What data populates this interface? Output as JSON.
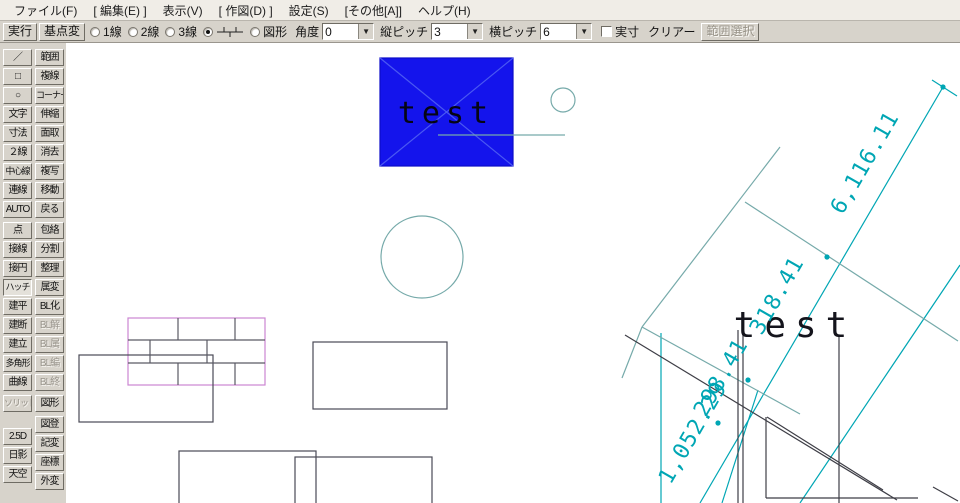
{
  "menu": {
    "items": [
      "ファイル(F)",
      "[ 編集(E) ]",
      "表示(V)",
      "[ 作図(D) ]",
      "設定(S)",
      "[その他[A]]",
      "ヘルプ(H)"
    ]
  },
  "toolbar": {
    "buttons": [
      {
        "label": "実行",
        "name": "execute-button"
      },
      {
        "label": "基点変",
        "name": "base-point-change-button"
      }
    ],
    "radios": [
      {
        "label": "1線",
        "selected": false
      },
      {
        "label": "2線",
        "selected": false
      },
      {
        "label": "3線",
        "selected": false
      },
      {
        "icon": "brick-pitch-icon",
        "selected": true
      },
      {
        "label": "図形",
        "selected": false
      }
    ],
    "fields": [
      {
        "label": "角度",
        "value": "0"
      },
      {
        "label": "縦ピッチ",
        "value": "3"
      },
      {
        "label": "横ピッチ",
        "value": "6"
      }
    ],
    "checkbox": {
      "label": "実寸",
      "checked": false
    },
    "clear_label": "クリアー",
    "range_select": {
      "label": "範囲選択",
      "disabled": true
    }
  },
  "sidebar": {
    "groups": [
      {
        "col1": [
          {
            "label": "／",
            "name": "line-tool-icon"
          },
          {
            "label": "□",
            "name": "rect-tool-icon"
          },
          {
            "label": "○",
            "name": "circle-tool-icon"
          },
          {
            "label": "文字"
          },
          {
            "label": "寸法"
          },
          {
            "label": "２線"
          },
          {
            "label": "中心線",
            "long": true
          },
          {
            "label": "連線"
          },
          {
            "label": "AUTO"
          }
        ],
        "col2": [
          {
            "label": "範囲"
          },
          {
            "label": "複線"
          },
          {
            "label": "コーナー",
            "long": true
          },
          {
            "label": "伸縮"
          },
          {
            "label": "面取"
          },
          {
            "label": "消去"
          },
          {
            "label": "複写"
          },
          {
            "label": "移動"
          },
          {
            "label": "戻る"
          }
        ]
      },
      {
        "col1": [
          {
            "label": "点"
          },
          {
            "label": "接線"
          },
          {
            "label": "接円"
          },
          {
            "label": "ハッチ",
            "active": true,
            "long": true
          },
          {
            "label": "建平"
          },
          {
            "label": "建断"
          },
          {
            "label": "建立"
          },
          {
            "label": "多角形",
            "long": true
          },
          {
            "label": "曲線"
          }
        ],
        "col2": [
          {
            "label": "包絡"
          },
          {
            "label": "分割"
          },
          {
            "label": "整理"
          },
          {
            "label": "属変"
          },
          {
            "label": "BL化"
          },
          {
            "label": "BL解",
            "disabled": true
          },
          {
            "label": "BL属",
            "disabled": true
          },
          {
            "label": "BL編",
            "disabled": true
          },
          {
            "label": "BL終",
            "disabled": true
          }
        ]
      },
      {
        "col1": [
          {
            "label": "ソリッド",
            "disabled": true,
            "long": true
          }
        ],
        "col2": [
          {
            "label": "図形"
          }
        ]
      },
      {
        "col1": [
          {
            "label": "2.5D"
          },
          {
            "label": "日影"
          },
          {
            "label": "天空"
          }
        ],
        "col2": [
          {
            "label": "図登"
          },
          {
            "label": "記変"
          },
          {
            "label": "座標"
          },
          {
            "label": "外変"
          }
        ]
      }
    ]
  },
  "drawing": {
    "colors": {
      "dim": "#00a6b4",
      "aux": "#76aaaa",
      "dark": "#3e3e46",
      "cross": "#4a58f2",
      "hatch": "#5a5a64",
      "hatchBorder": "#cc86d2",
      "outline": "#4a4a56",
      "blueFill": "#1414ec",
      "blueEdge": "#0c0cc8",
      "blueText": "#050514",
      "black": "#14141c"
    },
    "rects": [
      {
        "x": 380,
        "y": 58,
        "w": 133,
        "h": 108,
        "stroke": "blueEdge",
        "fill": "blueFill"
      },
      {
        "x": 128,
        "y": 318,
        "w": 137,
        "h": 67,
        "stroke": "hatchBorder"
      },
      {
        "x": 79,
        "y": 355,
        "w": 134,
        "h": 67,
        "stroke": "outline"
      },
      {
        "x": 313,
        "y": 342,
        "w": 134,
        "h": 67,
        "stroke": "outline"
      },
      {
        "x": 179,
        "y": 451,
        "w": 137,
        "h": 70,
        "stroke": "outline"
      },
      {
        "x": 295,
        "y": 457,
        "w": 137,
        "h": 70,
        "stroke": "outline"
      }
    ],
    "lines": [
      {
        "x1": 380,
        "y1": 58,
        "x2": 513,
        "y2": 166,
        "c": "cross"
      },
      {
        "x1": 380,
        "y1": 166,
        "x2": 513,
        "y2": 58,
        "c": "cross"
      },
      {
        "x1": 438,
        "y1": 135,
        "x2": 565,
        "y2": 135,
        "c": "aux"
      },
      {
        "x1": 128,
        "y1": 340,
        "x2": 265,
        "y2": 340,
        "c": "hatch"
      },
      {
        "x1": 128,
        "y1": 363,
        "x2": 265,
        "y2": 363,
        "c": "hatch"
      },
      {
        "x1": 178,
        "y1": 318,
        "x2": 178,
        "y2": 340,
        "c": "hatch"
      },
      {
        "x1": 235,
        "y1": 318,
        "x2": 235,
        "y2": 340,
        "c": "hatch"
      },
      {
        "x1": 150,
        "y1": 340,
        "x2": 150,
        "y2": 363,
        "c": "hatch"
      },
      {
        "x1": 207,
        "y1": 340,
        "x2": 207,
        "y2": 363,
        "c": "hatch"
      },
      {
        "x1": 178,
        "y1": 363,
        "x2": 178,
        "y2": 385,
        "c": "hatch"
      },
      {
        "x1": 235,
        "y1": 363,
        "x2": 235,
        "y2": 385,
        "c": "hatch"
      },
      {
        "x1": 943,
        "y1": 87,
        "x2": 700,
        "y2": 503,
        "c": "dim"
      },
      {
        "x1": 932,
        "y1": 80,
        "x2": 957,
        "y2": 96,
        "c": "dim"
      },
      {
        "x1": 960,
        "y1": 265,
        "x2": 800,
        "y2": 503,
        "c": "dim"
      },
      {
        "x1": 661,
        "y1": 333,
        "x2": 661,
        "y2": 503,
        "c": "dim"
      },
      {
        "x1": 758,
        "y1": 390,
        "x2": 722,
        "y2": 503,
        "c": "dim"
      },
      {
        "x1": 780,
        "y1": 147,
        "x2": 642,
        "y2": 327,
        "c": "aux"
      },
      {
        "x1": 642,
        "y1": 327,
        "x2": 800,
        "y2": 414,
        "c": "aux"
      },
      {
        "x1": 642,
        "y1": 327,
        "x2": 622,
        "y2": 378,
        "c": "aux"
      },
      {
        "x1": 745,
        "y1": 202,
        "x2": 958,
        "y2": 341,
        "c": "aux"
      },
      {
        "x1": 625,
        "y1": 335,
        "x2": 897,
        "y2": 500,
        "c": "dark"
      },
      {
        "x1": 767,
        "y1": 417,
        "x2": 883,
        "y2": 490,
        "c": "dark"
      },
      {
        "x1": 738,
        "y1": 330,
        "x2": 738,
        "y2": 503,
        "c": "dark"
      },
      {
        "x1": 743,
        "y1": 332,
        "x2": 743,
        "y2": 503,
        "c": "dark"
      },
      {
        "x1": 839,
        "y1": 335,
        "x2": 839,
        "y2": 503,
        "c": "dark"
      },
      {
        "x1": 766,
        "y1": 417,
        "x2": 766,
        "y2": 498,
        "c": "dark"
      },
      {
        "x1": 766,
        "y1": 498,
        "x2": 918,
        "y2": 498,
        "c": "dark"
      },
      {
        "x1": 933,
        "y1": 487,
        "x2": 958,
        "y2": 501,
        "c": "dark"
      }
    ],
    "circles": [
      {
        "cx": 563,
        "cy": 100,
        "r": 12,
        "stroke": "aux"
      },
      {
        "cx": 422,
        "cy": 257,
        "r": 41,
        "stroke": "aux"
      }
    ],
    "dots": [
      [
        943,
        87
      ],
      [
        827,
        257
      ],
      [
        748,
        380
      ],
      [
        718,
        423
      ]
    ],
    "texts": [
      {
        "t": "test",
        "x": 446,
        "y": 123,
        "s": 30,
        "ls": 6,
        "c": "blueText"
      },
      {
        "t": "test",
        "x": 795,
        "y": 337,
        "s": 36,
        "ls": 9,
        "c": "black"
      },
      {
        "t": "6,116.11",
        "x": 871,
        "y": 166,
        "s": 22,
        "ls": 1,
        "rot": -60,
        "c": "dim"
      },
      {
        "t": "318.41",
        "x": 783,
        "y": 299,
        "s": 22,
        "ls": 1,
        "rot": -60,
        "c": "dim"
      },
      {
        "t": "298.41",
        "x": 727,
        "y": 381,
        "s": 22,
        "ls": 1,
        "rot": -60,
        "c": "dim"
      },
      {
        "t": "1,052.29",
        "x": 699,
        "y": 436,
        "s": 22,
        "ls": 1,
        "rot": -60,
        "c": "dim"
      }
    ]
  }
}
